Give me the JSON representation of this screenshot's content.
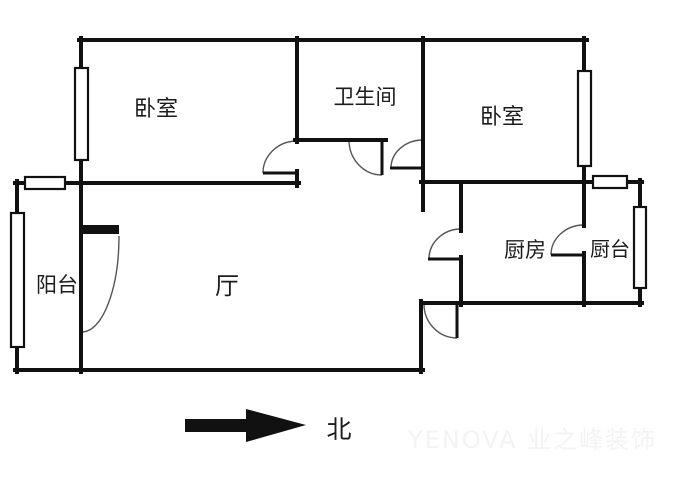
{
  "plan": {
    "type": "apartment-floor-plan",
    "rooms": {
      "bedroom_left": {
        "label": "卧室"
      },
      "bathroom": {
        "label": "卫生间"
      },
      "bedroom_right": {
        "label": "卧室"
      },
      "kitchen": {
        "label": "厨房"
      },
      "kitchen_counter": {
        "label": "厨台"
      },
      "balcony": {
        "label": "阳台"
      },
      "hall": {
        "label": "厅"
      }
    },
    "compass": {
      "label": "北",
      "arrow_direction": "right"
    },
    "watermark": {
      "text": "YENOVA 业之峰装饰"
    },
    "colors": {
      "wall": "#111111",
      "background": "#ffffff",
      "door_arc": "#555555",
      "text": "#1c1c1c",
      "watermark": "#f3f3f3"
    }
  }
}
